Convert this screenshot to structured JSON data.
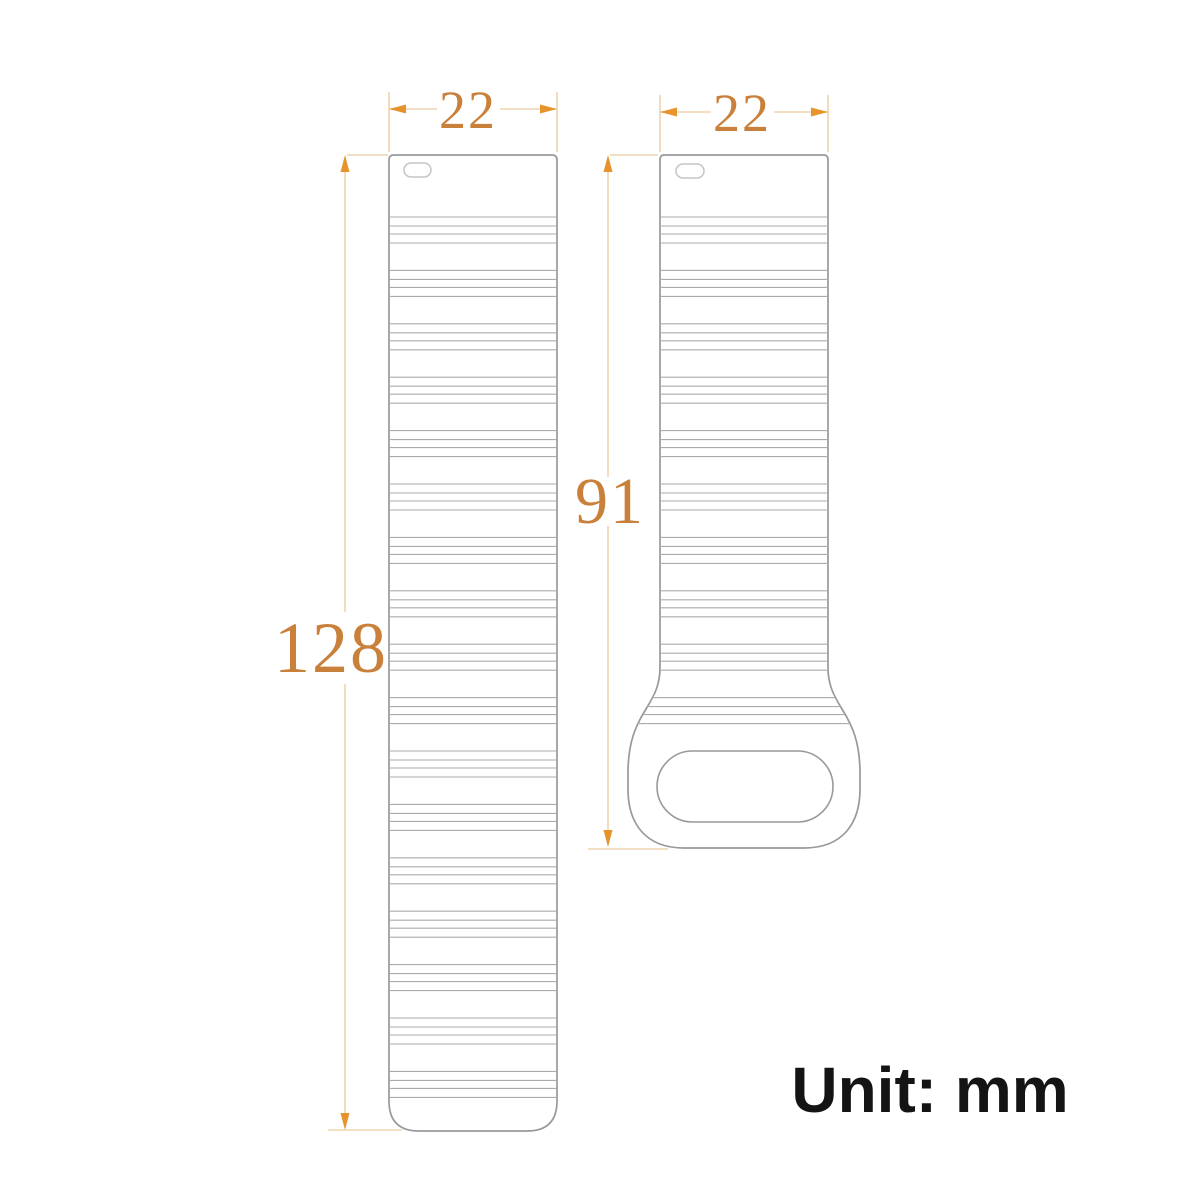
{
  "diagram": {
    "title": "watch band strap dimension drawing",
    "unit_note": "Unit: mm",
    "unit": "mm",
    "straps": [
      {
        "id": "long-strap",
        "width_label": "22",
        "length_label": "128"
      },
      {
        "id": "short-strap",
        "width_label": "22",
        "length_label": "91"
      }
    ]
  },
  "colors": {
    "background": "#ffffff",
    "dimension_line": "#eed4ae",
    "dimension_arrow": "#e6932c",
    "dimension_text": "#c9803a",
    "strap_outline": "#98999b",
    "strap_ridge": "#aaabad",
    "strap_slot": "#c3c5c7",
    "unit_text": "#141414"
  }
}
